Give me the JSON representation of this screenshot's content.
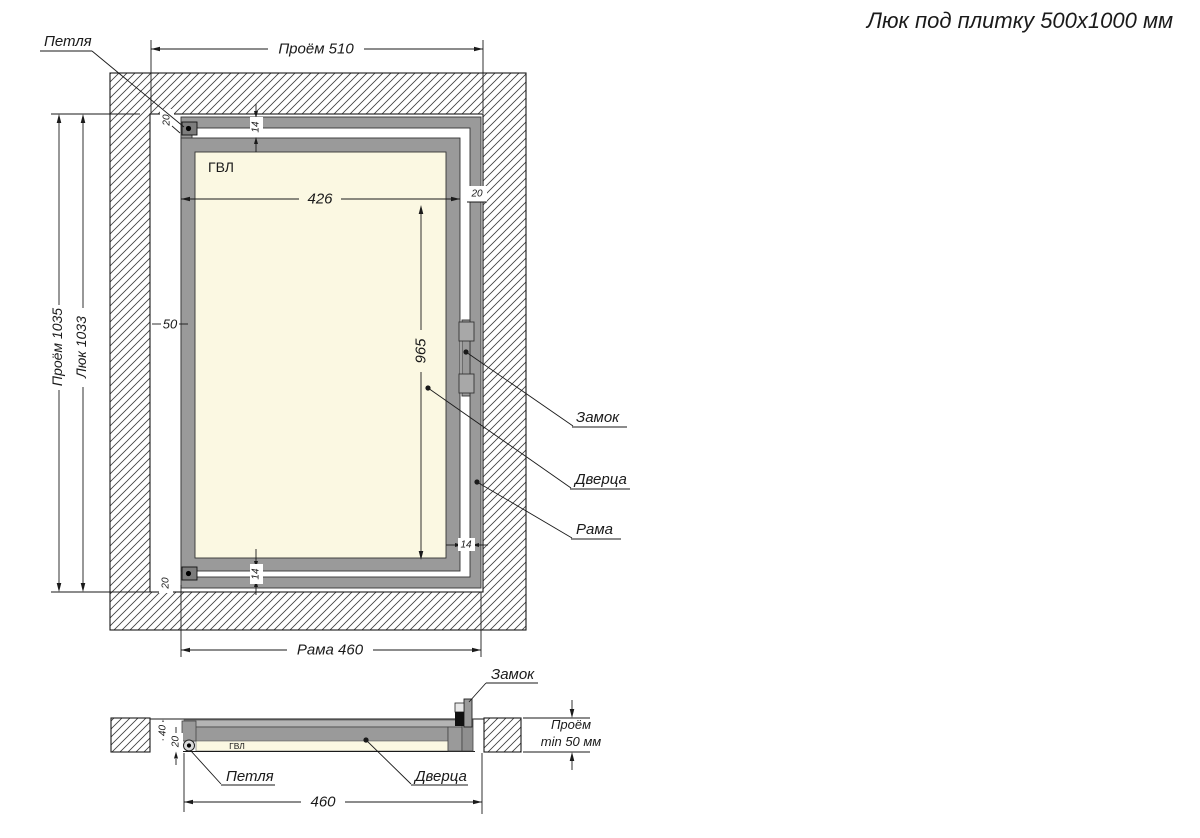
{
  "title": "Люк под плитку 500x1000 мм",
  "front": {
    "labels": {
      "hinge": "Петля",
      "lock": "Замок",
      "door": "Дверца",
      "frame": "Рама",
      "panel": "ГВЛ"
    },
    "dims": {
      "opening_width": "Проём 510",
      "opening_height": "Проём 1035",
      "hatch_height": "Люк 1033",
      "door_width": "426",
      "door_height": "965",
      "frame_width": "Рама 460",
      "side_gap": "50",
      "edge_top": "20",
      "edge_bottom": "20",
      "edge_right": "20",
      "seam_top": "14",
      "seam_bottom": "14",
      "seam_right": "14"
    }
  },
  "section": {
    "labels": {
      "lock": "Замок",
      "hinge": "Петля",
      "door": "Дверца",
      "panel": "ГВЛ"
    },
    "dims": {
      "frame_width": "460",
      "depth": "40",
      "panel_thickness": "20",
      "clearance_line1": "Проём",
      "clearance_line2": "min 50 мм"
    }
  },
  "colors": {
    "metal": "#9a9a9a",
    "metal_light": "#b4b4b4",
    "panel": "#fbf8e2",
    "line": "#1a1a1a",
    "hatch": "#3c3c3c"
  }
}
